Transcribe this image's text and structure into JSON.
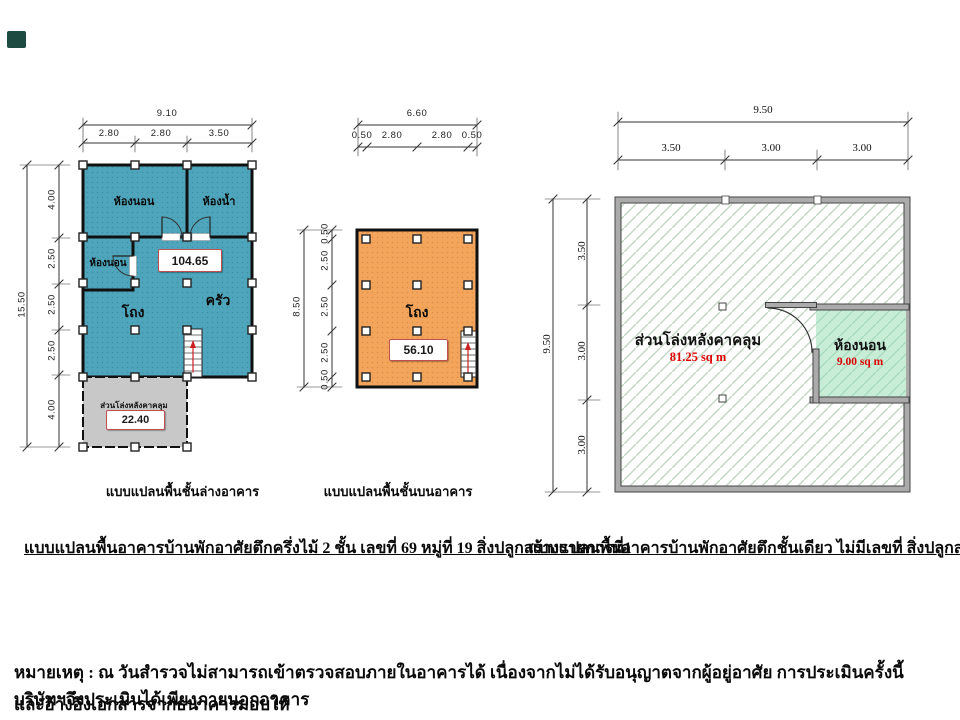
{
  "corner_mark": {
    "color": "#1D4A41"
  },
  "plan_ground": {
    "caption": "แบบแปลนพื้นชั้นล่างอาคาร",
    "fill_color": "#4FA6BC",
    "dim_width_total": "9.10",
    "dim_width_segments": [
      "2.80",
      "2.80",
      "3.50"
    ],
    "dim_height_total": "15.50",
    "dim_height_segments": [
      "4.00",
      "2.50",
      "2.50",
      "2.50",
      "4.00"
    ],
    "room_bedroom_top": "ห้องนอน",
    "room_bathroom": "ห้องน้ำ",
    "room_bedroom_left": "ห้องนอน",
    "room_hall": "โถง",
    "room_kitchen": "ครัว",
    "area_value": "104.65",
    "open_area_label": "ส่วนโล่งหลังคาคลุม",
    "open_area_value": "22.40"
  },
  "plan_upper": {
    "caption": "แบบแปลนพื้นชั้นบนอาคาร",
    "fill_color": "#F3A55C",
    "dim_width_total": "6.60",
    "dim_width_segments": [
      "0.50",
      "2.80",
      "2.80",
      "0.50"
    ],
    "dim_height_total": "8.50",
    "dim_height_segments": [
      "0.50",
      "2.50",
      "2.50",
      "2.50",
      "0.50"
    ],
    "room_hall": "โถง",
    "area_value": "56.10"
  },
  "plan_single": {
    "dim_width_total": "9.50",
    "dim_width_segments": [
      "3.50",
      "3.00",
      "3.00"
    ],
    "dim_height_total": "9.50",
    "dim_height_segments": [
      "3.50",
      "3.00",
      "3.00"
    ],
    "open_area_label": "ส่วนโล่งหลังคาคลุม",
    "open_area_value": "81.25 sq m",
    "bedroom_label": "ห้องนอน",
    "bedroom_area": "9.00 sq m",
    "bedroom_fill": "#C8EDD6",
    "accent_red": "#DD0000"
  },
  "captions": {
    "building1": "แบบแปลนพื้นอาคารบ้านพักอาศัยตึกครึ่งไม้ 2 ชั้น เลขที่ 69 หมู่ที่ 19 สิ่งปลูกสร้างรายการที่1",
    "building2": "แบบแปลนพื้นอาคารบ้านพักอาศัยตึกชั้นเดียว ไม่มีเลขที่ สิ่งปลูกสร้างรายการที่ 2"
  },
  "note": {
    "line1": "หมายเหตุ : ณ วันสำรวจไม่สามารถเข้าตรวจสอบภายในอาคารได้ เนื่องจากไม่ได้รับอนุญาตจากผู้อยู่อาศัย การประเมินครั้งนี้ บริษัทฯจึงประเมินได้เพียงภายนอกอาคาร",
    "line2": "และอ้างอิงเอกสารจากธนาคารมอบให้"
  }
}
